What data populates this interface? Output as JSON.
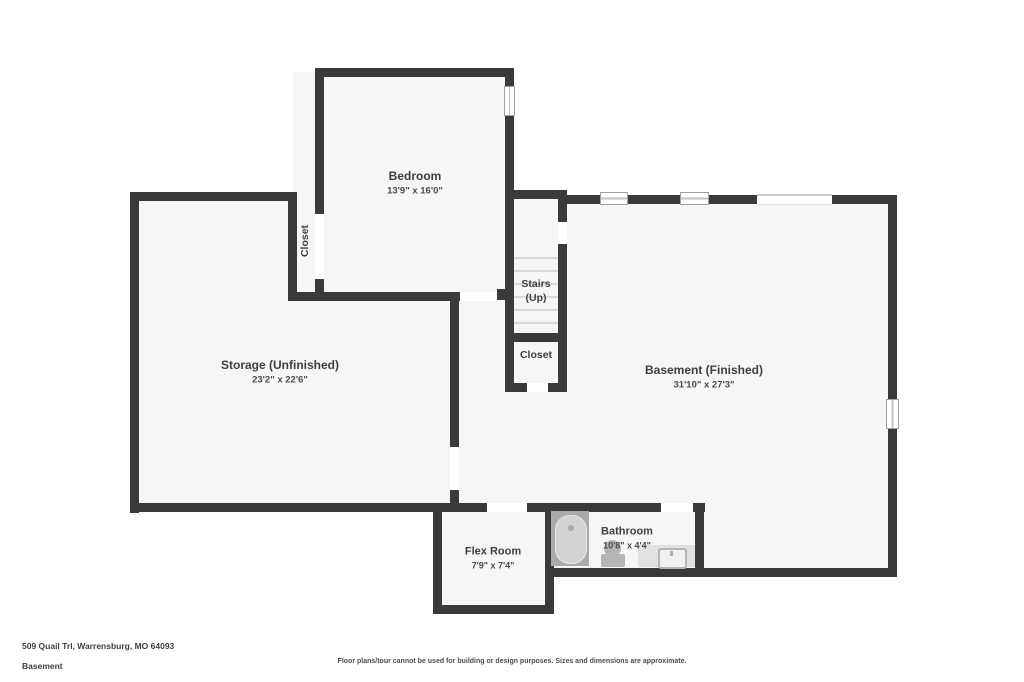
{
  "title": "Basement floor plan",
  "address": "509 Quail Trl, Warrensburg, MO 64093",
  "floor_name": "Basement",
  "disclaimer": "Floor plans/tour cannot be used for building or design purposes. Sizes and dimensions are approximate.",
  "colors": {
    "wall": "#3a3a3c",
    "floor": "#f6f6f6",
    "background": "#ffffff",
    "fixture_gray": "#b5b5b5",
    "label_text": "#3f3f41"
  },
  "icons": {
    "bathtub": "bathtub-icon",
    "toilet": "toilet-icon",
    "sink": "sink-icon",
    "window": "window-symbol",
    "stairs": "stair-treads"
  },
  "rooms": {
    "bedroom": {
      "label": "Bedroom",
      "dims": "13'9\" x 16'0\""
    },
    "bedroom_closet": {
      "label": "Closet"
    },
    "storage": {
      "label": "Storage (Unfinished)",
      "dims": "23'2\" x 22'6\""
    },
    "stairs": {
      "label": "Stairs",
      "sublabel": "(Up)"
    },
    "stairs_closet": {
      "label": "Closet"
    },
    "basement": {
      "label": "Basement (Finished)",
      "dims": "31'10\" x 27'3\""
    },
    "flex": {
      "label": "Flex Room",
      "dims": "7'9\" x 7'4\""
    },
    "bathroom": {
      "label": "Bathroom",
      "dims": "10'8\" x 4'4\""
    }
  }
}
